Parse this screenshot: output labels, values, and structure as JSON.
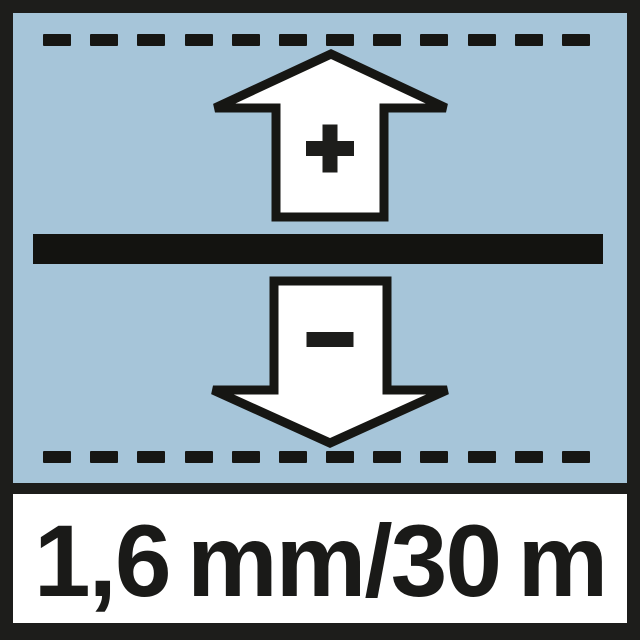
{
  "pictogram": {
    "accuracy_text": "1,6 mm/30 m",
    "plus_symbol": "+",
    "minus_symbol": "−",
    "dashed_lines": {
      "rows": [
        "top",
        "bottom"
      ],
      "count_per_row": 12
    },
    "colors": {
      "frame_black": "#1d1d1b",
      "panel_blue": "#a6c5d9",
      "glyph_black": "#161613",
      "arrow_fill": "#ffffff",
      "band_background": "#ffffff",
      "text_color": "#1a1a18"
    }
  }
}
